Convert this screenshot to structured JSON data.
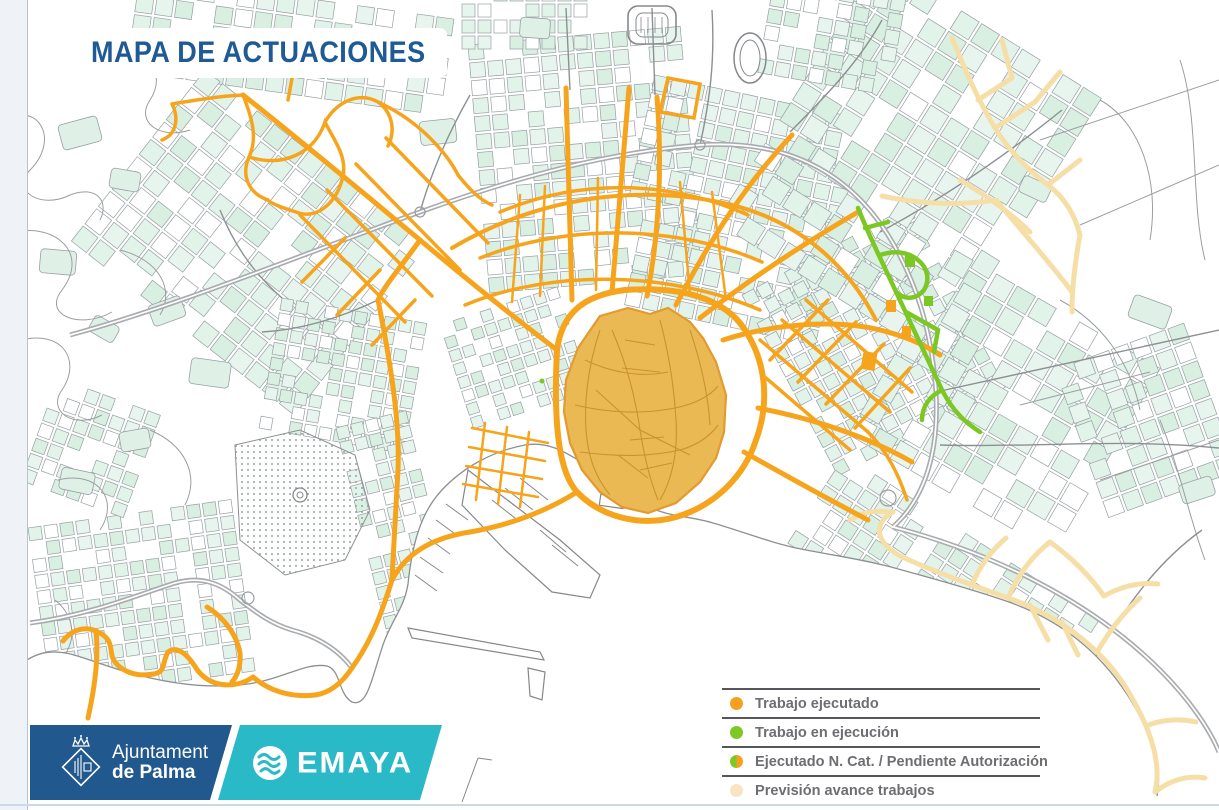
{
  "title": "MAPA DE ACTUACIONES",
  "legend": {
    "items": [
      {
        "label": "Trabajo ejecutado",
        "swatch": "orange",
        "color": "#F7A01E"
      },
      {
        "label": "Trabajo en ejecución",
        "swatch": "green",
        "color": "#7DC822"
      },
      {
        "label": "Ejecutado N. Cat. / Pendiente Autorización",
        "swatch": "split",
        "colors": [
          "#7DC822",
          "#F7A01E"
        ]
      },
      {
        "label": "Previsión avance trabajos",
        "swatch": "cream",
        "color": "#F8E4C2"
      }
    ]
  },
  "footer": {
    "ajuntament": {
      "line1": "Ajuntament",
      "line2": "de Palma"
    },
    "emaya": {
      "wordmark": "EMAYA"
    }
  },
  "map": {
    "palette": {
      "executed_orange": "#F7A41D",
      "old_town_fill": "#EBB954",
      "old_town_streets": "#C8932D",
      "in_progress_green": "#7CC822",
      "planned_cream": "#F6DFA7",
      "block_mint": "#E2F3EA",
      "street_gray": "#8D9093",
      "title_blue": "#1E5A96",
      "ajuntament_blue": "#21598F",
      "emaya_teal": "#29B9C7",
      "legend_text_gray": "#6D6E71"
    }
  }
}
